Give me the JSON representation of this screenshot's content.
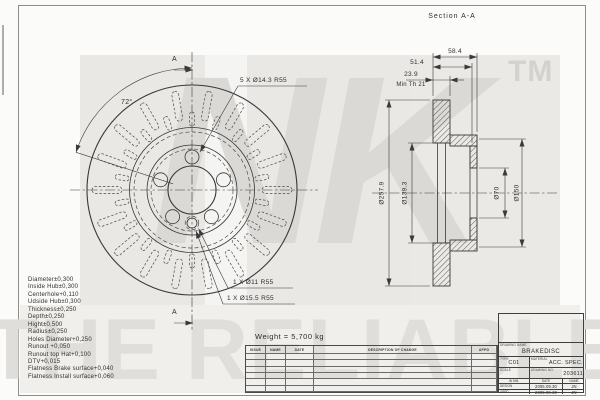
{
  "watermarks": {
    "brand": "NK",
    "tm": "TM",
    "slogan": "THE RELIABLE PART"
  },
  "front_view": {
    "section_marker_top": "A",
    "section_marker_bottom": "A",
    "angle_label": "72°",
    "bolt_pattern_label": "5 X Ø14.3 R55",
    "hole_label_1": "1 X Ø11 R55",
    "hole_label_2": "1 X Ø15.5 R55"
  },
  "section_view": {
    "title": "Section A-A",
    "dim_total_width": "58.4",
    "dim_inner_width": "51.4",
    "dim_thickness": "23.9",
    "dim_min_thickness": "Min Th 21",
    "dim_outer_diameter": "Ø257.9",
    "dim_vent_diameter": "Ø139.3",
    "dim_bore_diameter": "Ø70",
    "dim_hub_diameter": "Ø150"
  },
  "notes": {
    "weight": "Weight = 5,700 kg"
  },
  "tolerances": [
    "Diameter±0,300",
    "Inside Hub±0,300",
    "Centerhole+0,110",
    "Udside Hub±0,300",
    "Thickness±0,250",
    "Depth±0,250",
    "Hight±0,500",
    "Radius±0,250",
    "Holes Diameter+0,250",
    "Runout +0,050",
    "Runout top Hat+0,100",
    "DTV+0,015",
    "Flatness Brake surface+0,040",
    "Flatness Install surface+0,060"
  ],
  "revision_table": {
    "headers": [
      "ISSUE",
      "NAME",
      "DATE",
      "DESCRIPTION OF CHANGE",
      "APPD"
    ],
    "empty_rows": 6
  },
  "title_block": {
    "drawing_name_label": "DRAWING NAME",
    "drawing_name": "BRAKEDISC",
    "type_label": "TYPE",
    "type_value": "C01",
    "material_label": "MATERIAL",
    "material_value": "ACC. SPEC.",
    "scale_label": "SCALE",
    "drawing_no_label": "DRAWING NO.",
    "drawing_no": "203611",
    "units_label": "IN MM.",
    "date_label": "DATE",
    "name_label": "NAME",
    "design_label": "DESIGN",
    "design_date": "2005.09.30",
    "design_name": "JN",
    "appd_label": "APPD.",
    "appd_date": "2005.09.30",
    "appd_name": "JN"
  }
}
